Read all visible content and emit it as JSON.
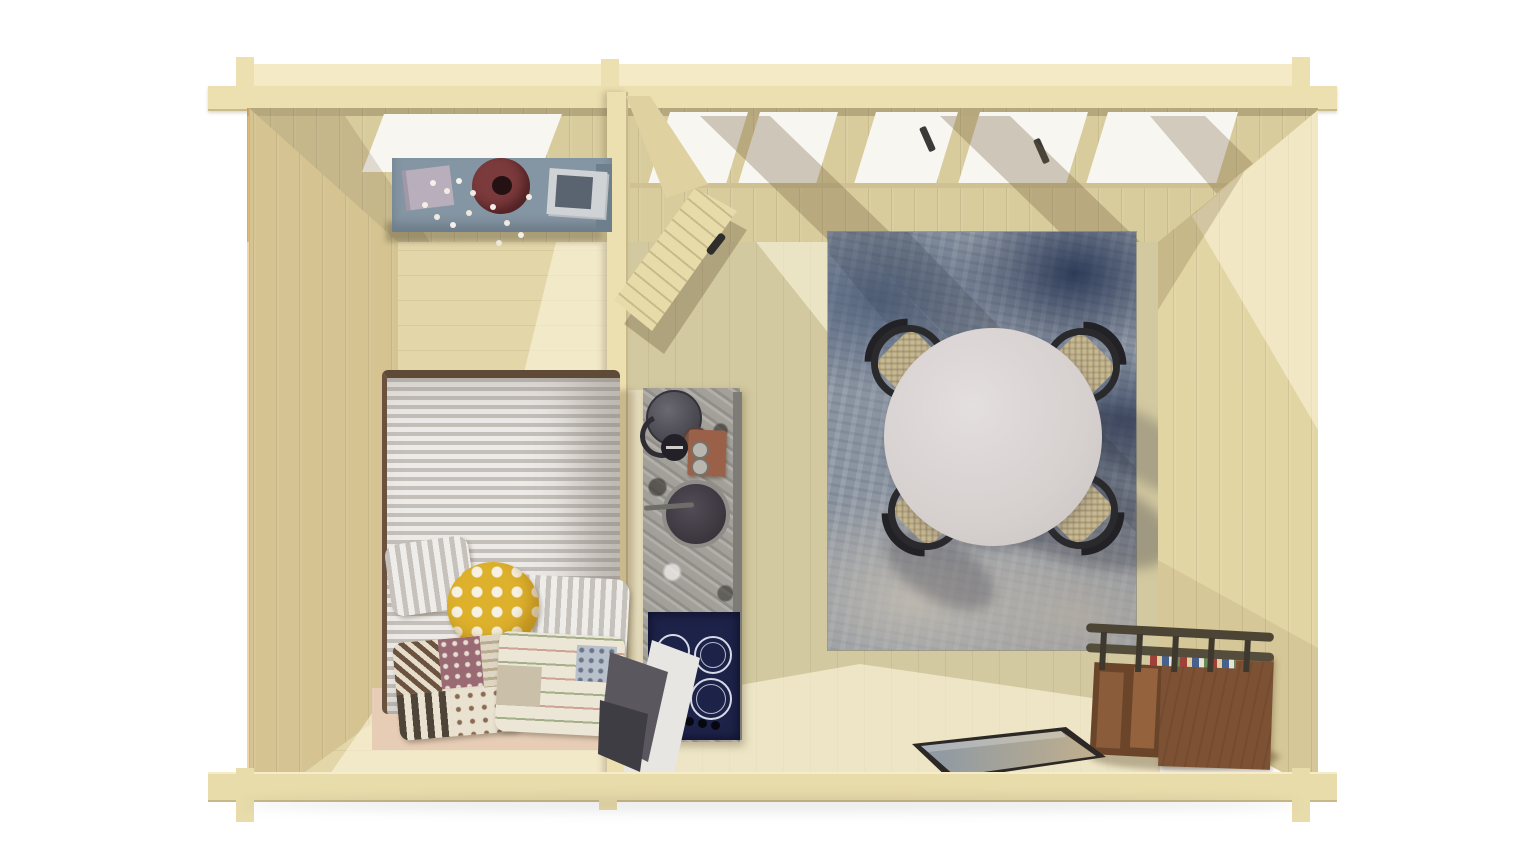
{
  "scene": {
    "title": "Top-down 3D cutaway render of a two-room wooden garden cabin",
    "rooms": [
      {
        "name": "bedroom",
        "contents": [
          "wall-shelf with book, red vase with white blossom branch, magazines",
          "double bed with grey striped duvet and dark trim",
          "two grey striped pillows",
          "yellow polka-dot round pillow",
          "two patchwork quilt pillows",
          "pale wood bed base"
        ]
      },
      {
        "name": "living-kitchen",
        "contents": [
          "open plank door into the room",
          "granite kitchen island: kettle, grinder, cutting board with two jars, round sink, tap",
          "navy induction cooktop with three burner rings and knobs",
          "grey folded chair beside cooktop",
          "distressed blue-grey area rug",
          "round white dining table",
          "four black wishbone chairs with woven seats",
          "brown wooden storage bench with rails and books",
          "multicolour doormat"
        ]
      }
    ],
    "architecture": [
      "log walls with cross-lap protruding corner joints",
      "five clerestory window panes along the back wall, two with dark handles",
      "partition wall with header beam",
      "sunlight falling diagonally from the back windows"
    ]
  },
  "palette": {
    "top_face": "#f4eac6",
    "top_plate": "#ecdfb0",
    "wall_back": "#d8cc9d",
    "wall_left": "#d5c492",
    "wall_right": "#e2d5a4",
    "divider": "#ecdfb0",
    "floor_bedroom": "#e3d6a8",
    "floor_living": "#d3c9a0",
    "front_plate": "#e9dcab",
    "window_glass": "#f8f6f1",
    "door_wood": "#e8dbaa",
    "shelf_blue": "#8495a3",
    "shelf_side": "#6d7e8c",
    "vase_red": "#7b3a3c",
    "book_lilac": "#b9aebc",
    "magazine_grey": "#cfd3d6",
    "duvet_trim": "#5f4a38",
    "pillow_yellow": "#ddb12c",
    "bed_base": "#e7cdb6",
    "counter_granite": "#a39f99",
    "counter_side": "#7e7c76",
    "kettle_dark": "#46444c",
    "cup_brown": "#7a5648",
    "board_brown": "#9a6148",
    "sink_dark": "#413c44",
    "cooktop_navy": "#1d2248",
    "chair_grey_seat": "#5a575e",
    "chair_grey_panel": "#e8e6e2",
    "rug_base": "#8b94a1",
    "rug_blue": "#46587a",
    "table_white": "#d8d3d2",
    "wishbone_frame": "#2a2a2d",
    "wishbone_seat": "#c7b894",
    "console_wood": "#7c5134",
    "console_dark": "#6b452a",
    "console_rail": "#4c4536",
    "doormat_frame": "#2c2825",
    "sunlight": "#fff9e4"
  }
}
